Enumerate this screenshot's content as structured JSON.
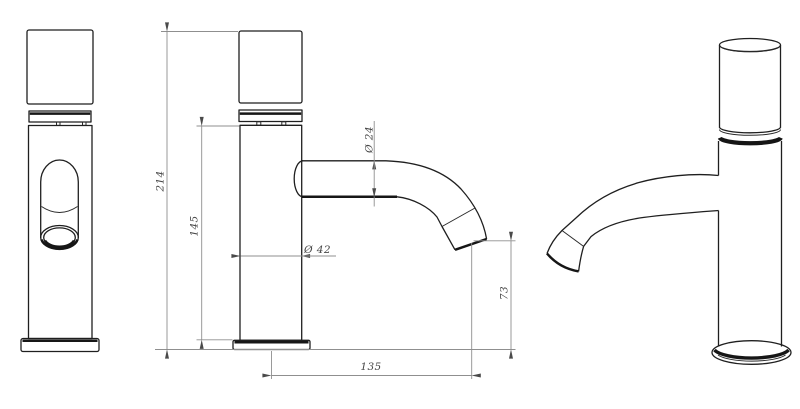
{
  "drawing": {
    "background_color": "#ffffff",
    "object_line_color": "#1f1f1f",
    "dimension_line_color": "#8f8f8f",
    "dimension_text_color": "#474747",
    "dimensions": {
      "total_height": "214",
      "spout_height": "145",
      "body_diameter": "Ø 42",
      "spout_diameter": "Ø 24",
      "outlet_clearance": "73",
      "spout_reach": "135"
    }
  }
}
